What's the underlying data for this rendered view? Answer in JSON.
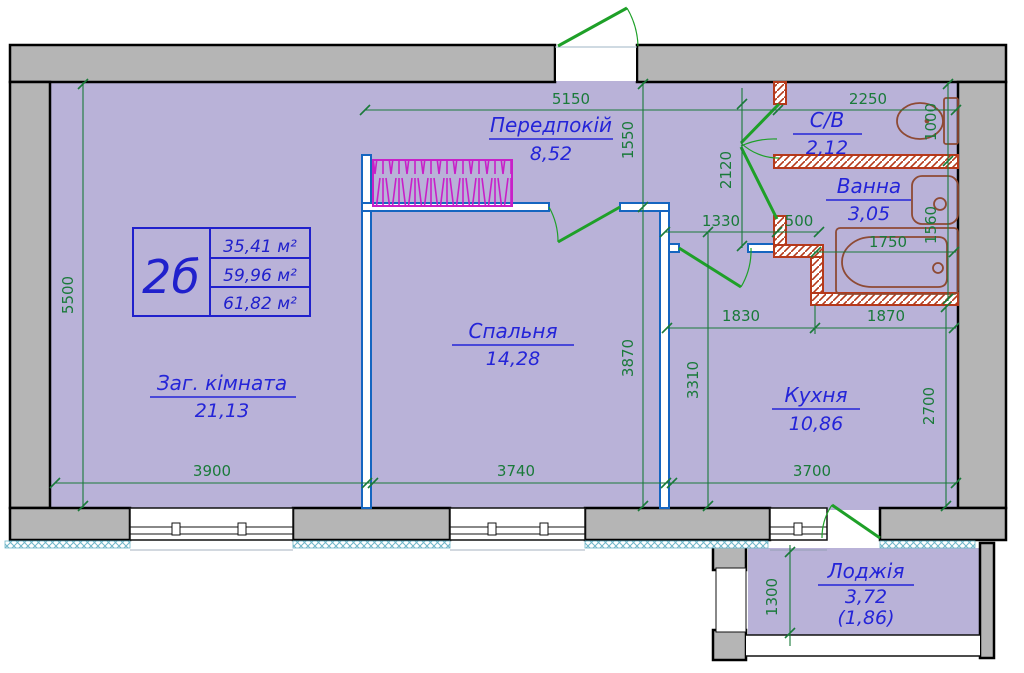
{
  "plan": {
    "title_block": {
      "unit": "2б",
      "living_area": "35,41 м²",
      "total_area": "59,96 м²",
      "full_area": "61,82 м²"
    },
    "rooms": {
      "living": {
        "name": "Заг. кімната",
        "area": "21,13"
      },
      "bedroom": {
        "name": "Спальня",
        "area": "14,28"
      },
      "hall": {
        "name": "Передпокій",
        "area": "8,52"
      },
      "wc": {
        "name": "С/В",
        "area": "2,12"
      },
      "bath": {
        "name": "Ванна",
        "area": "3,05"
      },
      "kitchen": {
        "name": "Кухня",
        "area": "10,86"
      },
      "loggia": {
        "name": "Лоджія",
        "area": "3,72",
        "area_half": "(1,86)"
      }
    },
    "dims": {
      "hall_width": "5150",
      "hall_depth": "1550",
      "wc_width": "2250",
      "wc_depth": "1000",
      "bath_doors_span": "2120",
      "hall_opening": "1330",
      "bath_wall_len": "500",
      "tub_len": "1750",
      "bath_depth": "1560",
      "hall_bottom_left": "1830",
      "bath_bottom": "1870",
      "bedroom_depth": "3870",
      "kitchen_hall_depth": "3310",
      "kitchen_depth": "2700",
      "living_depth": "5500",
      "living_width": "3900",
      "bedroom_width": "3740",
      "kitchen_width": "3700",
      "loggia_depth": "1300"
    },
    "colors": {
      "floor": "#b9b2d8",
      "wall": "#b5b5b5",
      "partition": "#1565c0",
      "dimension": "#1a7a3a",
      "door": "#1ea028",
      "label": "#2424d8",
      "wet_wall": "#b5391b",
      "fixture": "#8e4a34",
      "sill": "#6fb6c8",
      "wardrobe": "#c820c8"
    }
  }
}
